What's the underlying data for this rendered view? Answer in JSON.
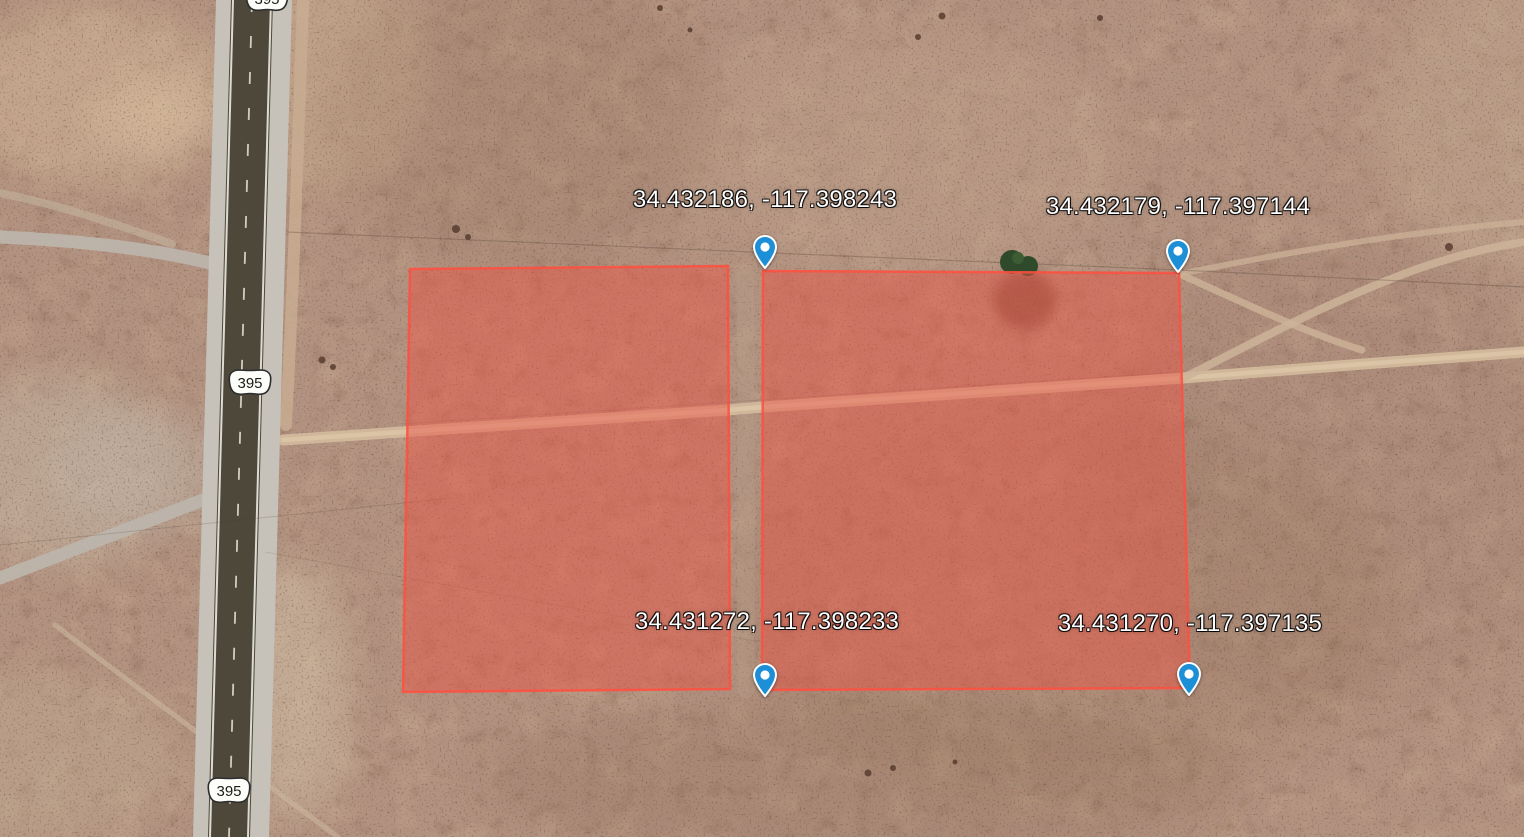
{
  "map": {
    "view": "satellite",
    "highway": {
      "route_label": "395"
    },
    "pins": [
      {
        "name": "top-left",
        "label": "34.432186, -117.398243"
      },
      {
        "name": "top-right",
        "label": "34.432179, -117.397144"
      },
      {
        "name": "bottom-left",
        "label": "34.431272, -117.398233"
      },
      {
        "name": "bottom-right",
        "label": "34.431270, -117.397135"
      }
    ],
    "parcels": [
      {
        "name": "west-parcel"
      },
      {
        "name": "east-parcel"
      }
    ],
    "colors": {
      "pin": "#1d8fd6",
      "label_text": "#ffffff",
      "parcel_fill": "#ed5444",
      "parcel_border": "#ff4f3f",
      "terrain_base": "#b29280"
    }
  }
}
